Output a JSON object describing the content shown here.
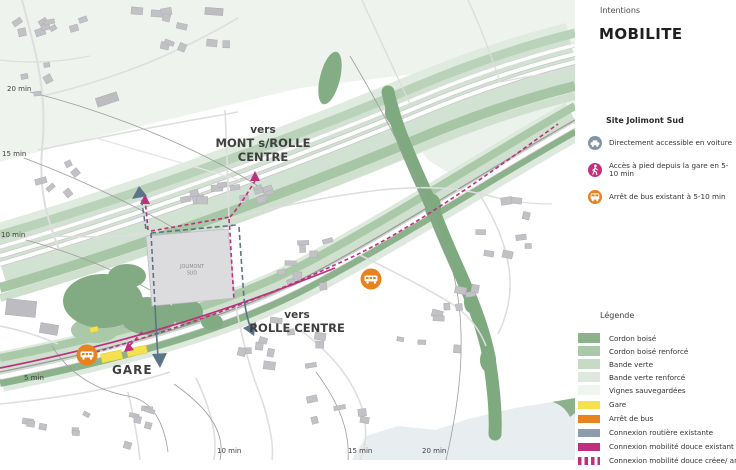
{
  "panel": {
    "kicker": "Intentions",
    "title": "MOBILITE",
    "site_section": {
      "heading": "Site Jolimont Sud",
      "items": [
        {
          "icon": "car-icon",
          "color": "#8295a5",
          "label": "Directement accessible en voiture"
        },
        {
          "icon": "pedestrian-icon",
          "color": "#c2307e",
          "label": "Accès à pied depuis la gare en 5-10 min"
        },
        {
          "icon": "bus-icon",
          "color": "#e8821f",
          "label": "Arrêt de bus existant à 5-10 min"
        }
      ]
    },
    "legend": {
      "heading": "Légende",
      "area_items": [
        {
          "label": "Cordon boisé",
          "color": "#8cb28c"
        },
        {
          "label": "Cordon boisé renforcé",
          "color": "#a9c9a9"
        },
        {
          "label": "Bande verte",
          "color": "#c6dac6"
        },
        {
          "label": "Bande verte renforcé",
          "color": "#dce9dc"
        },
        {
          "label": "Vignes sauvegardées",
          "color": "#eff5ef"
        }
      ],
      "point_items": [
        {
          "label": "Gare",
          "color": "#f5e14d",
          "style": "solid"
        },
        {
          "label": "Arrêt de bus",
          "color": "#e8821f",
          "style": "solid"
        },
        {
          "label": "Connexion routière existante",
          "color": "#8e9dab",
          "style": "solid"
        },
        {
          "label": "Connexion mobilité douce existant",
          "color": "#bf2f7d",
          "style": "solid"
        },
        {
          "label": "Connexion mobilité douce créee/ améliorée",
          "color": "#bf2f7d",
          "style": "dashed"
        }
      ]
    }
  },
  "map": {
    "labels": {
      "vers_mont": {
        "line1": "vers",
        "line2": "MONT s/ROLLE",
        "line3": "CENTRE"
      },
      "vers_rolle": {
        "line1": "vers",
        "line2": "ROLLE CENTRE"
      },
      "gare": "GARE",
      "site": {
        "line1": "JOLIMONT",
        "line2": "SUD"
      }
    },
    "isochrones": {
      "left": [
        "20 min",
        "15 min",
        "10 min",
        "5 min"
      ],
      "bottom": [
        "10 min",
        "15 min",
        "20 min"
      ]
    },
    "colors": {
      "magenta": "#bf2f7d",
      "blue_gray": "#5d7389",
      "orange": "#e8821f",
      "yellow": "#f5e14d"
    }
  }
}
